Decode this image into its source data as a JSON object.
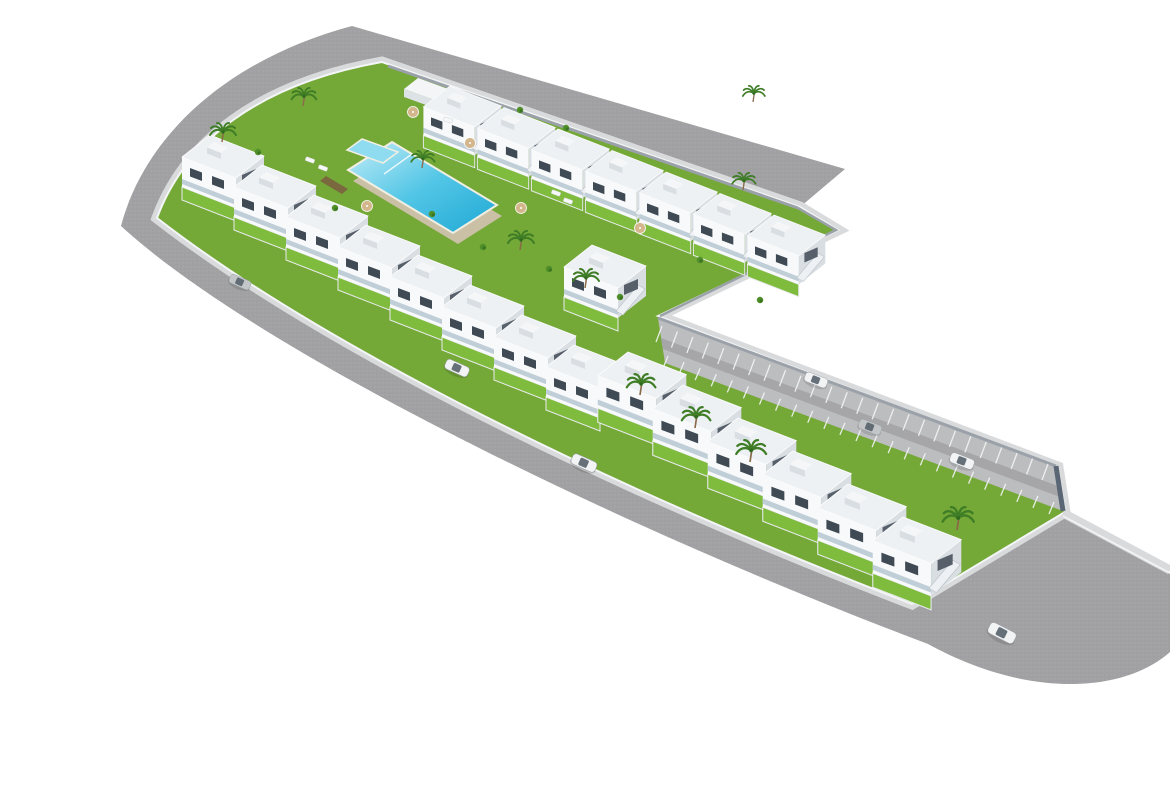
{
  "scene": {
    "alt": "aerial-3d-render-l-shaped-residential-complex-with-pool-garden-parking-and-perimeter-road",
    "canvas": {
      "width": 1170,
      "height": 785
    },
    "colors": {
      "background": "#ffffff",
      "road": "#a1a1a3",
      "road_speckle": "#8c8c8e",
      "sidewalk": "#d8dadc",
      "curb": "#f4f5f6",
      "grass": "#74a837",
      "garden": "#7fbc3e",
      "parking_apron": "#bcbdbf",
      "parking_lane": "#a6a6a8",
      "parking_stripe": "#f4f5f6",
      "wall_light": "#9aa1a8",
      "wall_dark": "#5a6673",
      "pool_wall": "#c9c0a6",
      "pool_shallow": "#c3edf7",
      "pool_mid": "#53c6e6",
      "pool_deep": "#1ea8d4",
      "pool_coping": "#f2efe2",
      "house_roof": "#eef1f3",
      "house_face_light": "#f7f9fa",
      "house_face_shade": "#d9dee3",
      "house_window": "#3f4a55",
      "balcony_glass": "#aebfcc",
      "stair": "#eef1f4",
      "deck_wood": "#7b5d3f",
      "palm_frond": "#3f7d26",
      "palm_trunk": "#8a6b4a",
      "bush": "#4e8f2a",
      "umbrella": "#d3b68c",
      "lounger": "#f6f7f8",
      "car_white": "#f2f3f4",
      "car_silver": "#c2c6c9",
      "car_glass": "#57626c"
    },
    "shapes": [
      {
        "name": "perimeter-road-surface",
        "d": "M 845,169 L 352,26 C 232,58 146,132 121,226 C 250,345 600,520 928,644 C 1030,700 1125,692 1170,652 L 1170,574 L 1062,514 C 1000,540 950,575 912,605 C 560,470 300,330 157,218 C 180,140 255,82 380,60 L 800,207 Z",
        "fill": "$road"
      },
      {
        "name": "perimeter-road-texture",
        "d": "M 845,169 L 352,26 C 232,58 146,132 121,226 C 250,345 600,520 928,644 C 1030,700 1125,692 1170,652 L 1170,574 L 1062,514 C 1000,540 950,575 912,605 C 560,470 300,330 157,218 C 180,140 255,82 380,60 L 800,207 Z",
        "fill": "url(#speckle)",
        "opacity": 0.35
      },
      {
        "name": "complex-sidewalk-band",
        "d": "M 157,218 C 185,142 258,84 382,62 L 800,207 L 838,230 L 658,316 L 1058,467 L 1065,512 L 912,604 C 560,468 300,329 157,218 Z",
        "fill": "none",
        "stroke": "$sidewalk",
        "width": 11
      },
      {
        "name": "complex-grounds",
        "d": "M 157,218 C 185,142 258,84 382,62 L 800,207 L 838,230 L 658,316 L 1058,467 L 1065,512 L 912,604 C 560,468 300,329 157,218 Z",
        "fill": "$grass"
      },
      {
        "name": "complex-curb-line",
        "d": "M 157,218 C 185,142 258,84 382,62 L 800,207 L 838,230 L 658,316 L 1058,467 L 1065,512 L 912,604 C 560,468 300,329 157,218 Z",
        "fill": "none",
        "stroke": "$curb",
        "width": 2
      },
      {
        "name": "right-sidewalk",
        "d": "M 1063,513 L 1170,570",
        "fill": "none",
        "stroke": "$sidewalk",
        "width": 9
      },
      {
        "name": "right-sidewalk-curb",
        "d": "M 1063,516 L 1170,573",
        "fill": "none",
        "stroke": "$curb",
        "width": 1.5
      },
      {
        "name": "parking-apron",
        "d": "M 658,318 L 1056,466 L 1063,511 L 665,363 Z",
        "fill": "$parking_apron"
      },
      {
        "name": "parking-lane",
        "d": "M 661,338 L 1058,486 L 1060,497 L 663,349 Z",
        "fill": "$parking_lane"
      },
      {
        "name": "parking-top-wall",
        "d": "M 658,318 L 1056,466",
        "fill": "none",
        "stroke": "$wall_light",
        "width": 3
      },
      {
        "name": "parking-end-wall",
        "d": "M 1056,466 L 1063,511",
        "fill": "none",
        "stroke": "$wall_dark",
        "width": 5
      },
      {
        "name": "perimeter-wall-top",
        "d": "M 388,66 L 798,208",
        "fill": "none",
        "stroke": "$wall_light",
        "width": 3
      },
      {
        "name": "ne-end-wall",
        "d": "M 798,208 L 836,230 L 660,316",
        "fill": "none",
        "stroke": "$wall_light",
        "width": 2.5
      },
      {
        "name": "pool-stone-wall",
        "d": "M 397,153 L 502,216 L 458,244 L 353,181 Z",
        "fill": "$pool_wall"
      },
      {
        "name": "pool-main",
        "d": "M 392,142 L 497,205 L 453,233 L 348,170 Z",
        "fill": "url(#poolGrad)",
        "stroke": "$pool_coping",
        "width": 2
      },
      {
        "name": "pool-shallow-step",
        "d": "M 412,154 L 384,174",
        "fill": "none",
        "stroke": "#e8f6fa",
        "width": 1.5
      },
      {
        "name": "pool-kids",
        "d": "M 362,139 L 398,152 L 383,163 L 347,150 Z",
        "fill": "#8fdbf0",
        "stroke": "$pool_coping",
        "width": 1.5
      },
      {
        "name": "pool-deck-strip-1",
        "d": "M 326,176 L 348,189 L 342,194 L 320,181 Z",
        "fill": "$deck_wood",
        "opacity": 0.85
      },
      {
        "name": "pool-deck-strip-2",
        "d": "M 306,194 L 328,207 L 322,212 L 300,199 Z",
        "fill": "$deck_wood",
        "opacity": 0.85
      },
      {
        "name": "garden-shed-roof",
        "d": "M 418,78 L 462,94 L 448,105 L 404,89 Z",
        "fill": "#f3f5f7"
      },
      {
        "name": "garden-shed-front",
        "d": "M 404,89 L 448,105 L 448,113 L 404,97 Z",
        "fill": "#dde2e6"
      }
    ],
    "parking_stripes": [
      {
        "name": "parking-stripes-upper",
        "from": [
          662,
          326
        ],
        "to": [
          1048,
          464
        ],
        "count": 26,
        "vec": [
          -6,
          16
        ]
      },
      {
        "name": "parking-stripes-lower",
        "from": [
          668,
          356
        ],
        "to": [
          1054,
          502
        ],
        "count": 25,
        "vec": [
          -5,
          12
        ]
      }
    ],
    "house_rows": [
      {
        "name": "row-top",
        "start": [
          450,
          86
        ],
        "step": [
          54,
          21.5
        ],
        "count": 7,
        "scale": 0.95
      },
      {
        "name": "row-corner-cap",
        "start": [
          592,
          245
        ],
        "step": [
          0,
          0
        ],
        "count": 1,
        "scale": 1.0
      },
      {
        "name": "row-left",
        "start": [
          210,
          135
        ],
        "step": [
          52,
          30
        ],
        "count": 8,
        "scale": 1.0
      },
      {
        "name": "row-lower-arm",
        "start": [
          628,
          352
        ],
        "step": [
          55,
          33
        ],
        "count": 6,
        "scale": 1.08
      }
    ],
    "palms": [
      [
        222,
        142,
        1.0
      ],
      [
        303,
        106,
        0.95
      ],
      [
        422,
        168,
        0.9
      ],
      [
        520,
        250,
        1.0
      ],
      [
        585,
        288,
        1.0
      ],
      [
        743,
        190,
        0.9
      ],
      [
        753,
        102,
        0.85
      ],
      [
        640,
        395,
        1.1
      ],
      [
        695,
        428,
        1.1
      ],
      [
        750,
        462,
        1.15
      ],
      [
        957,
        530,
        1.2
      ]
    ],
    "umbrellas": [
      [
        413,
        112
      ],
      [
        470,
        143
      ],
      [
        367,
        206
      ],
      [
        521,
        208
      ],
      [
        640,
        228
      ]
    ],
    "loungers": [
      [
        310,
        160,
        20
      ],
      [
        323,
        168,
        20
      ],
      [
        556,
        193,
        20
      ],
      [
        568,
        201,
        20
      ],
      [
        448,
        120,
        15
      ]
    ],
    "bushes": [
      [
        258,
        152
      ],
      [
        335,
        208
      ],
      [
        432,
        214
      ],
      [
        483,
        247
      ],
      [
        549,
        269
      ],
      [
        620,
        297
      ],
      [
        520,
        110
      ],
      [
        566,
        128
      ],
      [
        700,
        260
      ],
      [
        760,
        300
      ]
    ],
    "cars": [
      {
        "name": "car-road-upper-left",
        "x": 240,
        "y": 282,
        "rot": 24,
        "scale": 0.85,
        "color": "$car_silver"
      },
      {
        "name": "car-road-mid",
        "x": 457,
        "y": 368,
        "rot": 24,
        "scale": 0.95,
        "color": "$car_white"
      },
      {
        "name": "car-road-lower-mid",
        "x": 584,
        "y": 463,
        "rot": 24,
        "scale": 1.0,
        "color": "$car_white"
      },
      {
        "name": "car-road-bottom-corner",
        "x": 1002,
        "y": 633,
        "rot": 27,
        "scale": 1.1,
        "color": "$car_white"
      },
      {
        "name": "car-parking-1",
        "x": 816,
        "y": 380,
        "rot": 21,
        "scale": 0.9,
        "color": "$car_white"
      },
      {
        "name": "car-parking-2",
        "x": 870,
        "y": 427,
        "rot": 21,
        "scale": 0.9,
        "color": "$car_silver"
      },
      {
        "name": "car-parking-3",
        "x": 962,
        "y": 461,
        "rot": 21,
        "scale": 0.95,
        "color": "$car_white"
      }
    ],
    "summary": {
      "townhouse_units_visible": 22,
      "cars_visible": 7,
      "palm_trees_visible": 11,
      "pools": 2
    }
  }
}
